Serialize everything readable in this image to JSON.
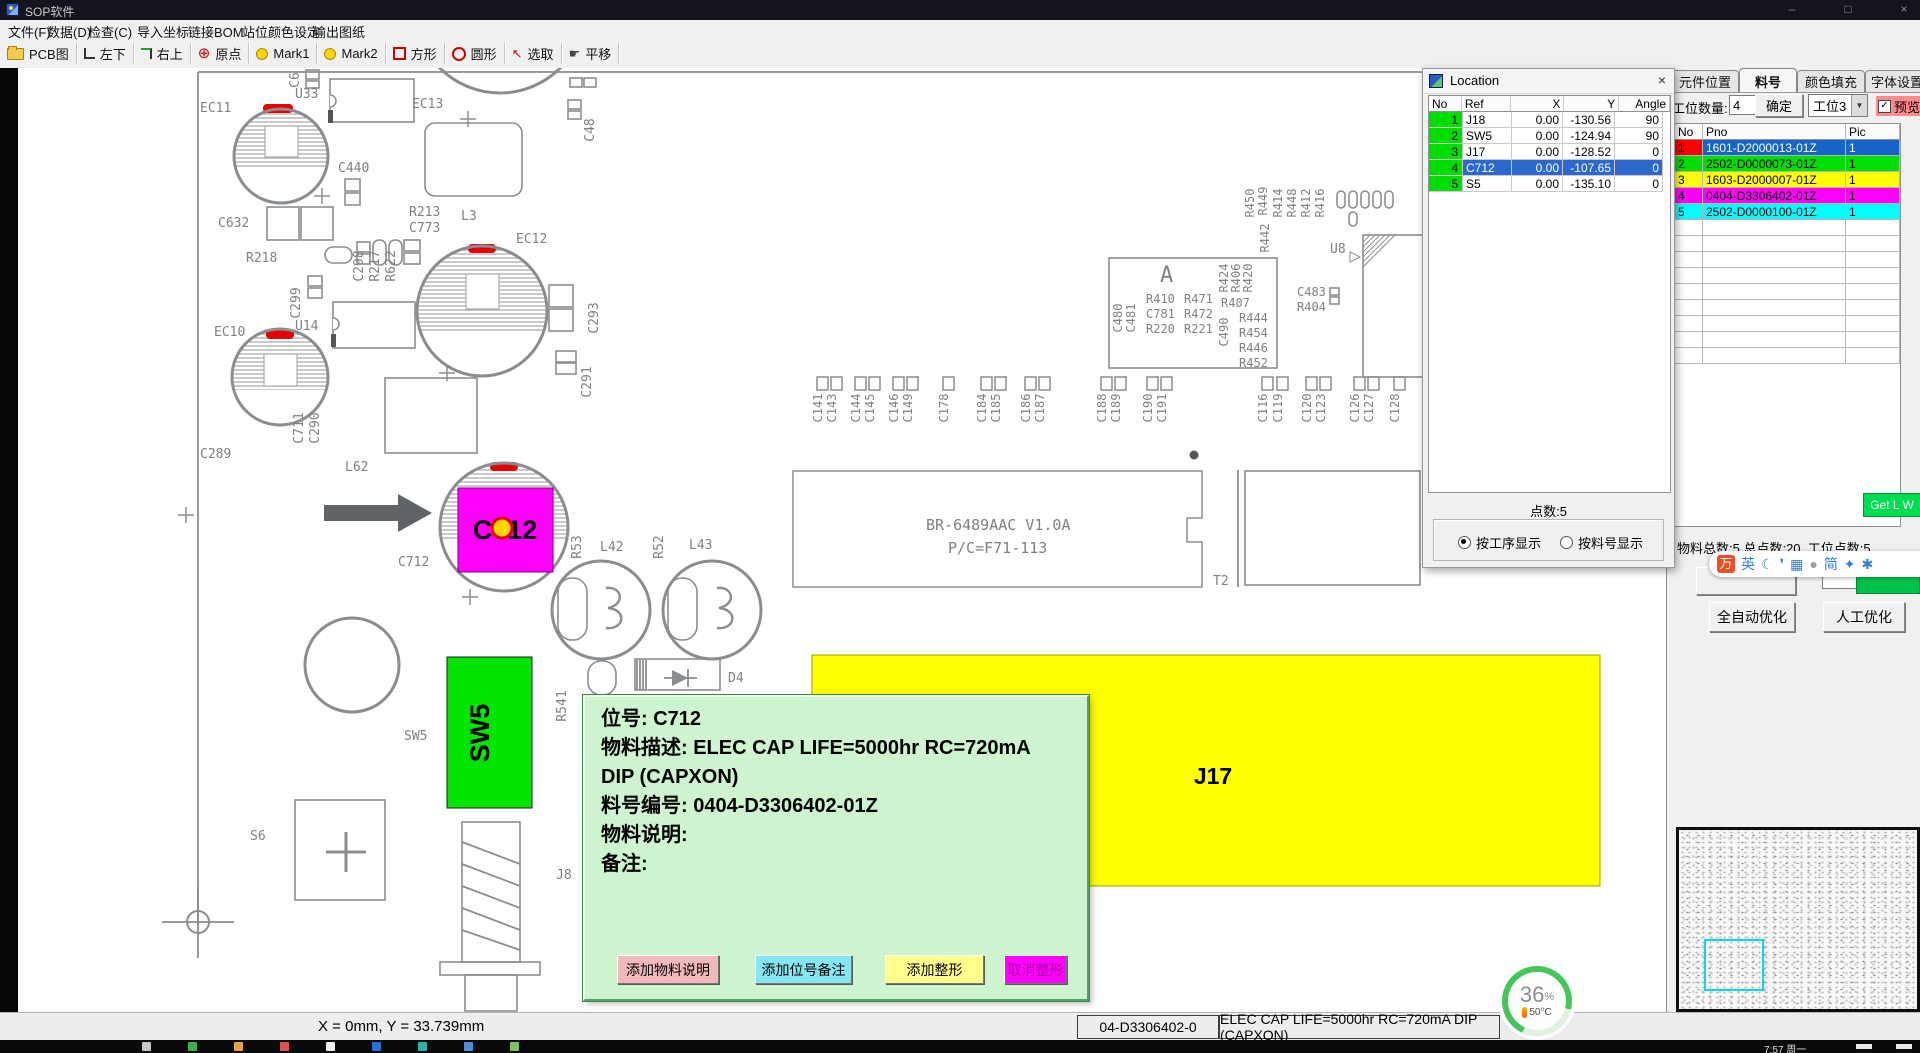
{
  "window": {
    "title": "SOP软件",
    "controls": [
      "–",
      "□",
      "×"
    ]
  },
  "menu": {
    "items": [
      "文件(F)",
      "数据(D)",
      "检查(C)",
      "导入坐标",
      "链接BOM",
      "站位颜色设定",
      "输出图纸"
    ]
  },
  "toolbar": {
    "items": [
      {
        "icon": "folder-icon",
        "label": "PCB图"
      },
      {
        "icon": "corner-bottom-left-icon",
        "label": "左下"
      },
      {
        "icon": "corner-top-right-icon",
        "label": "右上"
      },
      {
        "icon": "origin-crosshair-icon",
        "label": "原点"
      },
      {
        "icon": "mark1-dot-icon",
        "label": "Mark1"
      },
      {
        "icon": "mark2-dot-icon",
        "label": "Mark2"
      },
      {
        "icon": "square-icon",
        "label": "方形"
      },
      {
        "icon": "circle-icon",
        "label": "圆形"
      },
      {
        "icon": "select-arrow-icon",
        "label": "选取"
      },
      {
        "icon": "pan-hand-icon",
        "label": "平移"
      }
    ]
  },
  "location": {
    "title": "Location",
    "close": "×",
    "columns": [
      "No",
      "Ref",
      "X",
      "Y",
      "Angle"
    ],
    "rows": [
      {
        "no": "1",
        "ref": "J18",
        "x": "0.00",
        "y": "-130.56",
        "angle": "90",
        "selected": false
      },
      {
        "no": "2",
        "ref": "SW5",
        "x": "0.00",
        "y": "-124.94",
        "angle": "90",
        "selected": false
      },
      {
        "no": "3",
        "ref": "J17",
        "x": "0.00",
        "y": "-128.52",
        "angle": "0",
        "selected": false
      },
      {
        "no": "4",
        "ref": "C712",
        "x": "0.00",
        "y": "-107.65",
        "angle": "0",
        "selected": true
      },
      {
        "no": "5",
        "ref": "S5",
        "x": "0.00",
        "y": "-135.10",
        "angle": "0",
        "selected": false
      }
    ],
    "points": "点数:5",
    "radio_by_process": "按工序显示",
    "radio_by_part": "按料号显示"
  },
  "sidebar": {
    "tabs": [
      "元件位置",
      "料号",
      "颜色填充",
      "字体设置"
    ],
    "station_label": "工位数量:",
    "station_value": "4",
    "confirm": "确定",
    "station_select": "工位3",
    "preview": "预览",
    "check": "✓",
    "table": {
      "columns": [
        "No",
        "Pno",
        "Pic"
      ],
      "rows": [
        {
          "no": "1",
          "pno": "1601-D2000013-01Z",
          "pic": "1",
          "no_bg": "#ff0000",
          "row_bg": "#1565c8",
          "fg": "#ffffff",
          "no_fg": "#000000"
        },
        {
          "no": "2",
          "pno": "2502-D0000073-01Z",
          "pic": "1",
          "no_bg": "#00dd00",
          "row_bg": "#00dd00",
          "fg": "#000000",
          "no_fg": "#000000"
        },
        {
          "no": "3",
          "pno": "1603-D2000007-01Z",
          "pic": "1",
          "no_bg": "#ffff00",
          "row_bg": "#ffff00",
          "fg": "#000000",
          "no_fg": "#000000"
        },
        {
          "no": "4",
          "pno": "0404-D3306402-01Z",
          "pic": "1",
          "no_bg": "#ff00ff",
          "row_bg": "#ff00ff",
          "fg": "#000000",
          "no_fg": "#000000"
        },
        {
          "no": "5",
          "pno": "2502-D0000100-01Z",
          "pic": "1",
          "no_bg": "#00ffff",
          "row_bg": "#00ffff",
          "fg": "#000000",
          "no_fg": "#000000"
        }
      ]
    },
    "get_lw": "Get L W",
    "totals": "物料总数:5  总点数:20.  工位点数:5",
    "auto_btn": "全自动优化",
    "manual_btn": "人工优化"
  },
  "ime": {
    "icons": [
      {
        "name": "ime-logo-icon",
        "glyph": "万"
      },
      {
        "name": "english-mode-icon",
        "glyph": "英"
      },
      {
        "name": "moon-icon",
        "glyph": "☾"
      },
      {
        "name": "punctuation-icon",
        "glyph": "❜"
      },
      {
        "name": "keyboard-icon",
        "glyph": "▦"
      },
      {
        "name": "user-icon",
        "glyph": "●"
      },
      {
        "name": "simplified-icon",
        "glyph": "简"
      },
      {
        "name": "skin-icon",
        "glyph": "✦"
      },
      {
        "name": "gear-icon",
        "glyph": "✱"
      }
    ]
  },
  "popup": {
    "lines": [
      "位号:   C712",
      "物料描述:   ELEC CAP LIFE=5000hr RC=720mA",
      "DIP (CAPXON)",
      "料号编号:  0404-D3306402-01Z",
      "物料说明:",
      "备注:"
    ],
    "buttons": [
      {
        "label": "添加物料说明",
        "bg": "#f2b9bd",
        "fg": "#000000",
        "left": 32,
        "width": 100
      },
      {
        "label": "添加位号备注",
        "bg": "#84e6f2",
        "fg": "#000000",
        "left": 170,
        "width": 95
      },
      {
        "label": "添加整形",
        "bg": "#ffff8e",
        "fg": "#000000",
        "left": 300,
        "width": 97
      },
      {
        "label": "取消整形",
        "bg": "#ff00ff",
        "fg": "#a4009e",
        "left": 419,
        "width": 61
      }
    ]
  },
  "status": {
    "coords": "X = 0mm, Y = 33.739mm",
    "part_no": "04-D3306402-0",
    "part_desc": "ELEC CAP LIFE=5000hr RC=720mA DIP (CAPXON)"
  },
  "monitor": {
    "percent": "36",
    "percent_sign": "%",
    "temp": "50°C"
  },
  "taskbar": {
    "time": "7:57 周一"
  },
  "pcb": {
    "labels": [
      {
        "t": "C6",
        "x": 299,
        "y": 80,
        "r": -90
      },
      {
        "t": "EC11",
        "x": 200,
        "y": 112
      },
      {
        "t": "U33",
        "x": 295,
        "y": 98
      },
      {
        "t": "EC13",
        "x": 412,
        "y": 108
      },
      {
        "t": "C48",
        "x": 594,
        "y": 130,
        "r": -90
      },
      {
        "t": "C440",
        "x": 338,
        "y": 172
      },
      {
        "t": "C632",
        "x": 218,
        "y": 227
      },
      {
        "t": "R218",
        "x": 246,
        "y": 262
      },
      {
        "t": "C298",
        "x": 363,
        "y": 266,
        "r": -90
      },
      {
        "t": "R217",
        "x": 379,
        "y": 266,
        "r": -90
      },
      {
        "t": "R622",
        "x": 395,
        "y": 266,
        "r": -90
      },
      {
        "t": "R213",
        "x": 409,
        "y": 216
      },
      {
        "t": "C773",
        "x": 409,
        "y": 232
      },
      {
        "t": "L3",
        "x": 461,
        "y": 220
      },
      {
        "t": "EC12",
        "x": 516,
        "y": 243
      },
      {
        "t": "C299",
        "x": 300,
        "y": 303,
        "r": -90
      },
      {
        "t": "U14",
        "x": 295,
        "y": 330
      },
      {
        "t": "C293",
        "x": 598,
        "y": 318,
        "r": -90
      },
      {
        "t": "C291",
        "x": 591,
        "y": 382,
        "r": -90
      },
      {
        "t": "EC10",
        "x": 214,
        "y": 336
      },
      {
        "t": "C289",
        "x": 200,
        "y": 458
      },
      {
        "t": "C711",
        "x": 303,
        "y": 428,
        "r": -90
      },
      {
        "t": "C290",
        "x": 319,
        "y": 428,
        "r": -90
      },
      {
        "t": "L62",
        "x": 345,
        "y": 471
      },
      {
        "t": "C712",
        "x": 398,
        "y": 566
      },
      {
        "t": "R53",
        "x": 581,
        "y": 547,
        "r": -90
      },
      {
        "t": "L42",
        "x": 600,
        "y": 551
      },
      {
        "t": "R52",
        "x": 663,
        "y": 547,
        "r": -90
      },
      {
        "t": "L43",
        "x": 689,
        "y": 549
      },
      {
        "t": "R541",
        "x": 566,
        "y": 706,
        "r": -90
      },
      {
        "t": "D4",
        "x": 728,
        "y": 682
      },
      {
        "t": "SW5",
        "x": 404,
        "y": 740
      },
      {
        "t": "S6",
        "x": 250,
        "y": 840
      },
      {
        "t": "J8",
        "x": 556,
        "y": 879
      },
      {
        "t": "T2",
        "x": 1213,
        "y": 585
      },
      {
        "t": "A",
        "x": 1160,
        "y": 282,
        "s": 22
      },
      {
        "t": "C480",
        "x": 1122,
        "y": 318,
        "r": -90,
        "s": 12
      },
      {
        "t": "C481",
        "x": 1135,
        "y": 318,
        "r": -90,
        "s": 12
      },
      {
        "t": "R410",
        "x": 1146,
        "y": 303,
        "s": 12
      },
      {
        "t": "C781",
        "x": 1146,
        "y": 318,
        "s": 12
      },
      {
        "t": "R220",
        "x": 1146,
        "y": 333,
        "s": 12
      },
      {
        "t": "R471",
        "x": 1184,
        "y": 303,
        "s": 12
      },
      {
        "t": "R472",
        "x": 1184,
        "y": 318,
        "s": 12
      },
      {
        "t": "R221",
        "x": 1184,
        "y": 333,
        "s": 12
      },
      {
        "t": "R424",
        "x": 1228,
        "y": 278,
        "r": -90,
        "s": 12
      },
      {
        "t": "R406",
        "x": 1240,
        "y": 278,
        "r": -90,
        "s": 12
      },
      {
        "t": "R420",
        "x": 1252,
        "y": 278,
        "r": -90,
        "s": 12
      },
      {
        "t": "R407",
        "x": 1221,
        "y": 307,
        "s": 12
      },
      {
        "t": "C490",
        "x": 1228,
        "y": 332,
        "r": -90,
        "s": 12
      },
      {
        "t": "R444",
        "x": 1239,
        "y": 322,
        "s": 12
      },
      {
        "t": "R454",
        "x": 1239,
        "y": 337,
        "s": 12
      },
      {
        "t": "R446",
        "x": 1239,
        "y": 352,
        "s": 12
      },
      {
        "t": "R452",
        "x": 1239,
        "y": 367,
        "s": 12
      },
      {
        "t": "R450",
        "x": 1254,
        "y": 203,
        "r": -90,
        "s": 12
      },
      {
        "t": "R449",
        "x": 1267,
        "y": 201,
        "r": -90,
        "s": 12
      },
      {
        "t": "R442",
        "x": 1269,
        "y": 238,
        "r": -90,
        "s": 12
      },
      {
        "t": "R414",
        "x": 1282,
        "y": 203,
        "r": -90,
        "s": 12
      },
      {
        "t": "R448",
        "x": 1296,
        "y": 203,
        "r": -90,
        "s": 12
      },
      {
        "t": "R412",
        "x": 1310,
        "y": 203,
        "r": -90,
        "s": 12
      },
      {
        "t": "R416",
        "x": 1324,
        "y": 203,
        "r": -90,
        "s": 12
      },
      {
        "t": "U8",
        "x": 1330,
        "y": 253
      },
      {
        "t": "C483",
        "x": 1297,
        "y": 296,
        "s": 12
      },
      {
        "t": "R404",
        "x": 1297,
        "y": 311,
        "s": 12
      },
      {
        "t": "C141",
        "x": 822,
        "y": 408,
        "r": -90,
        "s": 12
      },
      {
        "t": "C143",
        "x": 836,
        "y": 408,
        "r": -90,
        "s": 12
      },
      {
        "t": "C144",
        "x": 860,
        "y": 408,
        "r": -90,
        "s": 12
      },
      {
        "t": "C145",
        "x": 874,
        "y": 408,
        "r": -90,
        "s": 12
      },
      {
        "t": "C146",
        "x": 898,
        "y": 408,
        "r": -90,
        "s": 12
      },
      {
        "t": "C149",
        "x": 912,
        "y": 408,
        "r": -90,
        "s": 12
      },
      {
        "t": "C178",
        "x": 948,
        "y": 408,
        "r": -90,
        "s": 12
      },
      {
        "t": "C184",
        "x": 986,
        "y": 408,
        "r": -90,
        "s": 12
      },
      {
        "t": "C185",
        "x": 1000,
        "y": 408,
        "r": -90,
        "s": 12
      },
      {
        "t": "C186",
        "x": 1030,
        "y": 408,
        "r": -90,
        "s": 12
      },
      {
        "t": "C187",
        "x": 1044,
        "y": 408,
        "r": -90,
        "s": 12
      },
      {
        "t": "C188",
        "x": 1106,
        "y": 408,
        "r": -90,
        "s": 12
      },
      {
        "t": "C189",
        "x": 1120,
        "y": 408,
        "r": -90,
        "s": 12
      },
      {
        "t": "C190",
        "x": 1152,
        "y": 408,
        "r": -90,
        "s": 12
      },
      {
        "t": "C191",
        "x": 1166,
        "y": 408,
        "r": -90,
        "s": 12
      },
      {
        "t": "C116",
        "x": 1267,
        "y": 408,
        "r": -90,
        "s": 12
      },
      {
        "t": "C119",
        "x": 1282,
        "y": 408,
        "r": -90,
        "s": 12
      },
      {
        "t": "C120",
        "x": 1311,
        "y": 408,
        "r": -90,
        "s": 12
      },
      {
        "t": "C123",
        "x": 1325,
        "y": 408,
        "r": -90,
        "s": 12
      },
      {
        "t": "C126",
        "x": 1359,
        "y": 408,
        "r": -90,
        "s": 12
      },
      {
        "t": "C127",
        "x": 1373,
        "y": 408,
        "r": -90,
        "s": 12
      },
      {
        "t": "C128",
        "x": 1399,
        "y": 408,
        "r": -90,
        "s": 12
      },
      {
        "t": "BR-6489AAC V1.0A",
        "x": 926,
        "y": 530,
        "s": 15
      },
      {
        "t": "P/C=F71-113",
        "x": 948,
        "y": 553,
        "s": 15
      },
      {
        "t": "C712",
        "x": 505,
        "y": 539,
        "s": 27,
        "b": 1,
        "c": "#000000",
        "a": "m"
      },
      {
        "t": "SW5",
        "x": 489,
        "y": 733,
        "r": -90,
        "s": 27,
        "b": 1,
        "c": "#000000",
        "a": "m"
      },
      {
        "t": "J17",
        "x": 1213,
        "y": 784,
        "s": 23,
        "b": 1,
        "c": "#000000",
        "a": "m"
      }
    ]
  }
}
